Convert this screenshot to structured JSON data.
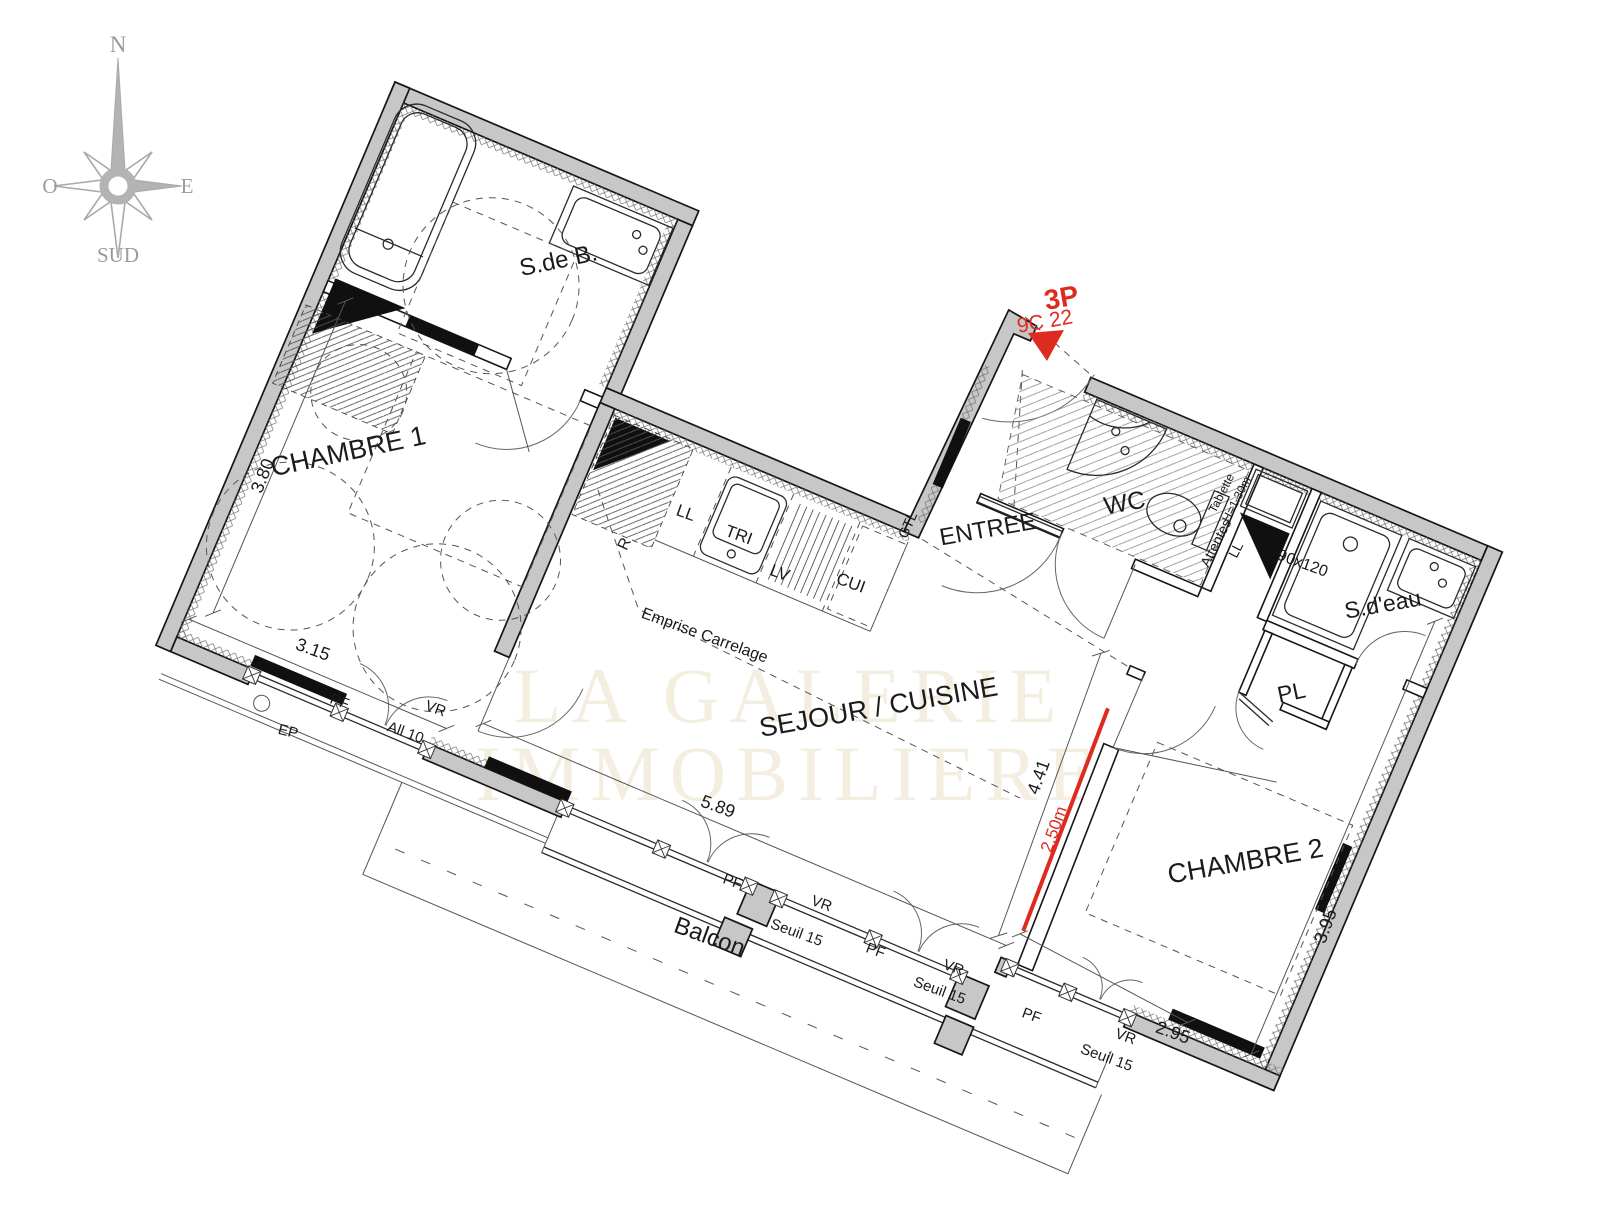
{
  "plan": {
    "rooms": {
      "sdb": "S.de B.",
      "chambre1": "CHAMBRE 1",
      "sejour": "SEJOUR / CUISINE",
      "entree": "ENTREE",
      "wc": "WC",
      "sdeau": "S.d'eau",
      "pl": "PL",
      "chambre2": "CHAMBRE 2",
      "balcon": "Balcon"
    },
    "kitchen": {
      "ll": "LL",
      "tri": "TRI",
      "lv": "LV",
      "cui": "CUI",
      "r": "R",
      "emprise": "Emprise Carrelage"
    },
    "openings": {
      "pf": "PF",
      "vr": "VR",
      "seuil": "Seuil 15",
      "all10": "All 10",
      "ep": "EP",
      "gtl": "GTL"
    },
    "fixtures": {
      "attentes_1": "Attentes",
      "attentes_2": "LL",
      "tablette_1": "Tablette",
      "tablette_2": "H=1.30m",
      "shower": "90x120"
    },
    "dimensions": {
      "d380": "3.80",
      "d315": "3.15",
      "d589": "5.89",
      "d441": "4.41",
      "d250": "2.50m",
      "d395": "3.95",
      "d295": "2.95"
    },
    "unit": {
      "type": "3P",
      "code": "9C 22"
    },
    "compass": {
      "n": "N",
      "e": "E",
      "o": "O",
      "sud": "SUD"
    },
    "watermark": {
      "l1": "LA GALERIE",
      "l2": "IMMOBILIERE"
    },
    "colors": {
      "wall": "#c7c7c7",
      "line": "#161616",
      "red": "#dd2b20",
      "compass": "#a9a9a9",
      "watermark": "#f4eee0"
    }
  }
}
